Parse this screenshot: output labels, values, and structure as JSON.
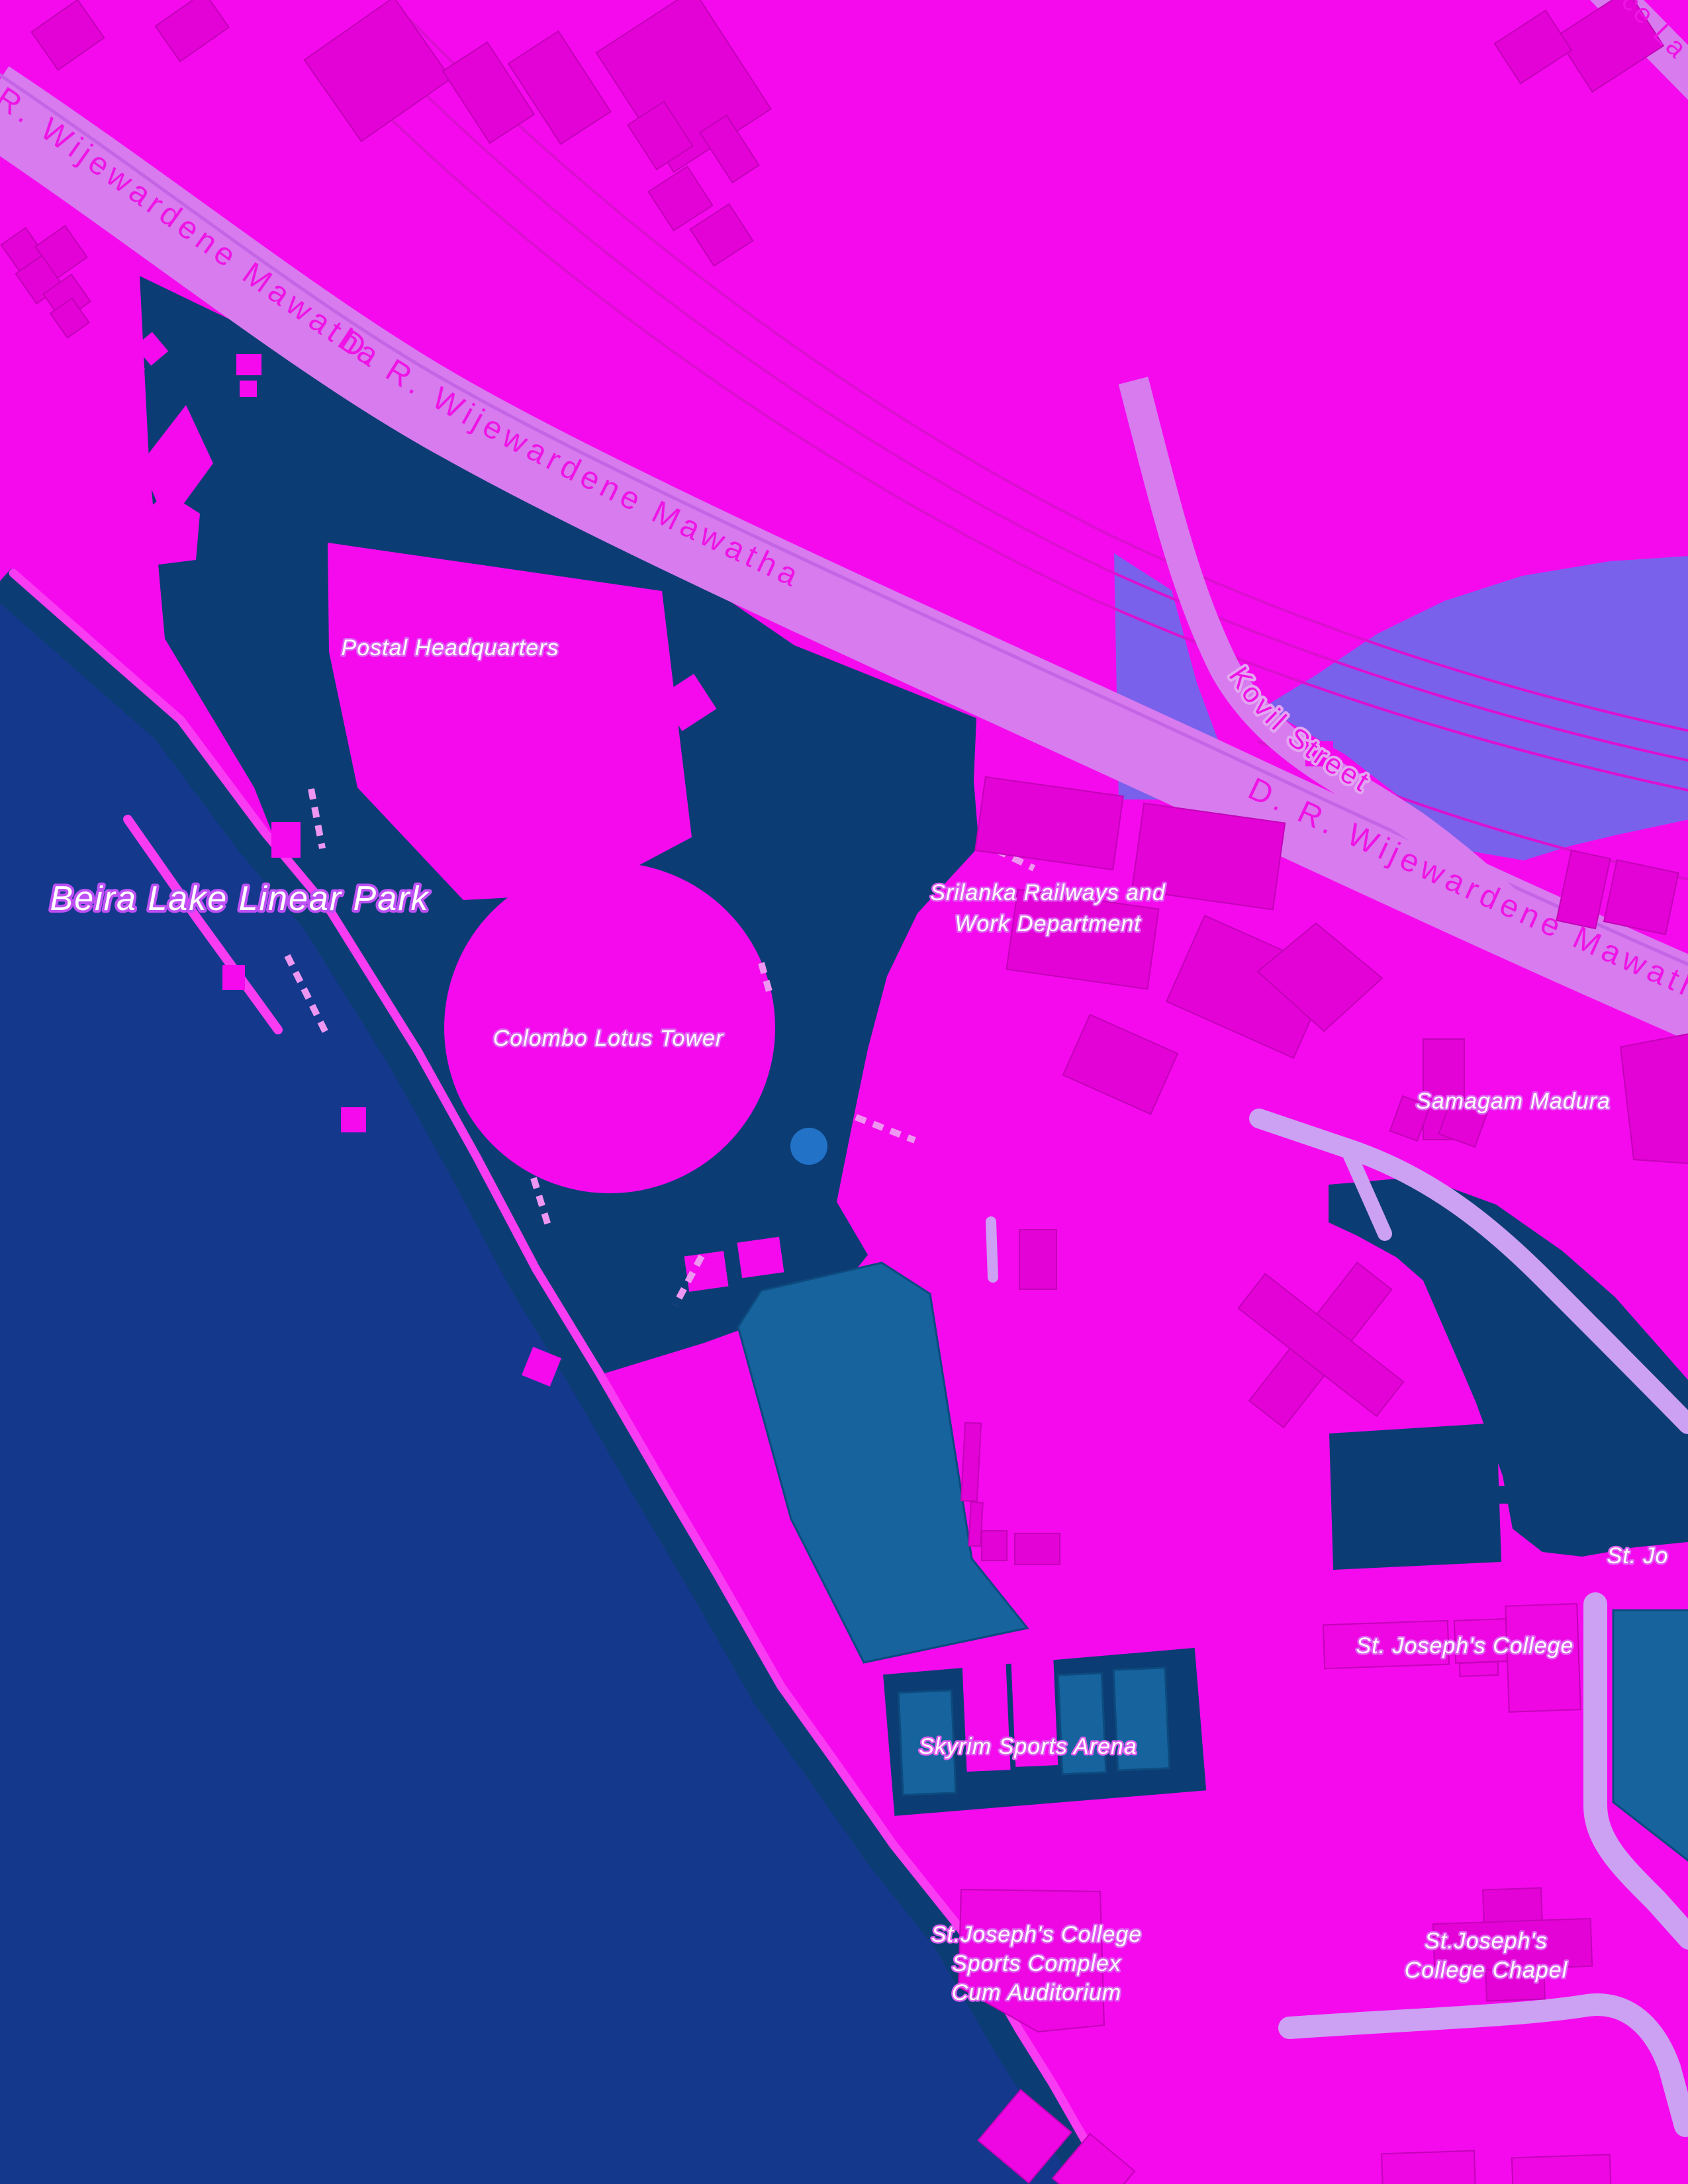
{
  "map": {
    "labels": {
      "roads": {
        "top_left": "R. Wijewardene Mawatha",
        "main_mid": "D. R. Wijewardene Mawatha",
        "main_right": "D. R. Wijewardene Mawatha",
        "kovil": "Kovil Street",
        "corner_stub": "ce La"
      },
      "places": {
        "beira_park": "Beira Lake Linear Park",
        "postal": "Postal Headquarters",
        "lotus": "Colombo Lotus Tower",
        "railways_line1": "Srilanka Railways and",
        "railways_line2": "Work Department",
        "samagam": "Samagam Madura",
        "college": "St. Joseph's College",
        "college_partial": "St. Jo",
        "skyrim": "Skyrim Sports Arena",
        "complex_line1": "St.Joseph's College",
        "complex_line2": "Sports Complex",
        "complex_line3": "Cum Auditorium",
        "chapel_line1": "St.Joseph's",
        "chapel_line2": "College Chapel"
      }
    },
    "colors": {
      "land": "#F50AEE",
      "building": "#E403D6",
      "building_light": "#EE07E2",
      "building_stroke": "#C203B8",
      "road_major": "#D77BEE",
      "road_minor": "#CCA0F2",
      "road_median": "#C465E6",
      "road_label": "#EF13E6",
      "road_halo": "#E3A6F2",
      "water": "#14388C",
      "ground_dark": "#0C3C74",
      "slate_area": "#7A61EC",
      "teal_fill": "#16639E",
      "teal_stroke": "#0D4A7E",
      "path_pink": "#F93BF2",
      "path_dash": "#EE96F2",
      "railway": "#DC10D0",
      "label_white": "#FFFFFF",
      "label_glow": "#E060F2",
      "label_glow_big": "#BE50F5",
      "dot_blue": "#2273C8"
    }
  }
}
